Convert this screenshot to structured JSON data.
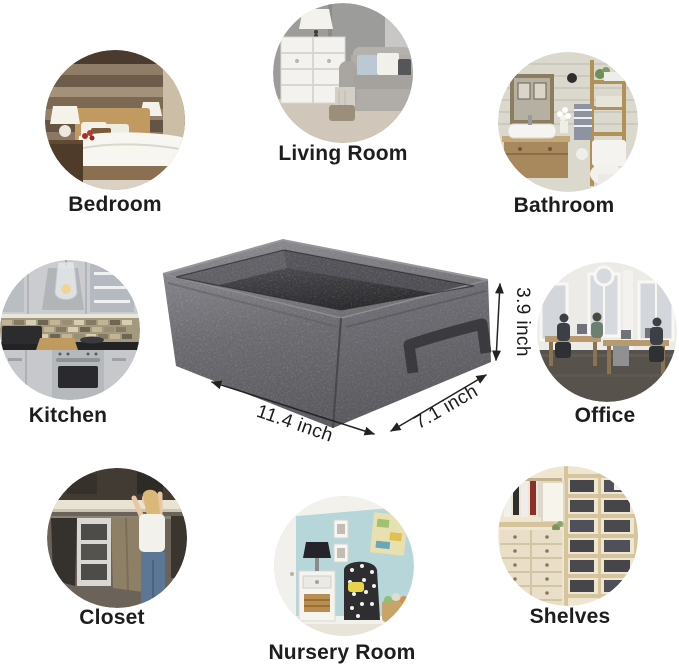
{
  "page": {
    "background": "#ffffff"
  },
  "product": {
    "name": "gray-felt-storage-basket",
    "dimensions": {
      "length": "11.4 inch",
      "width": "7.1 inch",
      "height": "3.9 inch"
    },
    "colors": {
      "felt_light": "#828286",
      "felt_mid": "#68686c",
      "felt_dark": "#55555a",
      "interior_dark": "#2e2e31",
      "handle": "#3b3b3f",
      "dimension_text": "#1b1b1b",
      "label_text": "#1d1d1d"
    }
  },
  "rooms": [
    {
      "id": "bedroom",
      "label": "Bedroom"
    },
    {
      "id": "living-room",
      "label": "Living Room"
    },
    {
      "id": "bathroom",
      "label": "Bathroom"
    },
    {
      "id": "kitchen",
      "label": "Kitchen"
    },
    {
      "id": "office",
      "label": "Office"
    },
    {
      "id": "closet",
      "label": "Closet"
    },
    {
      "id": "nursery-room",
      "label": "Nursery Room"
    },
    {
      "id": "shelves",
      "label": "Shelves"
    }
  ]
}
